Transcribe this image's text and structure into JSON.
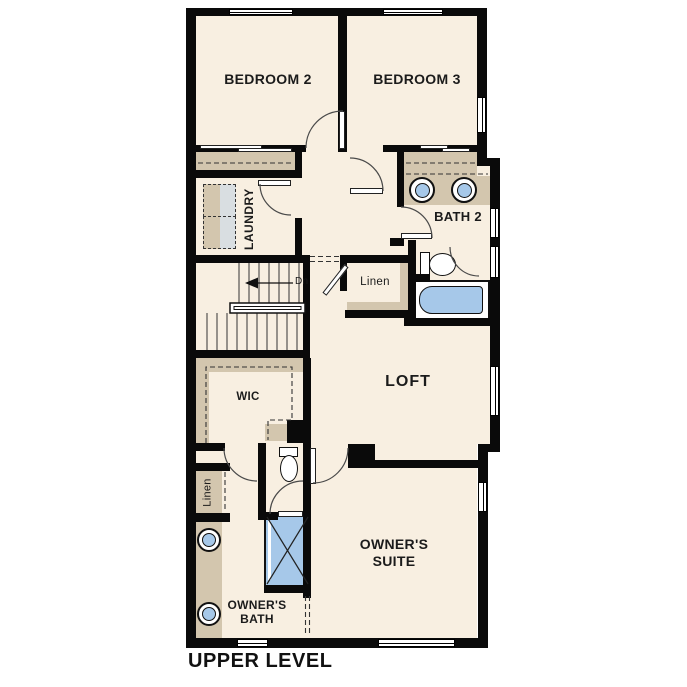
{
  "plan_title": "UPPER LEVEL",
  "labels": {
    "bedroom2": "BEDROOM 2",
    "bedroom3": "BEDROOM 3",
    "laundry": "LAUNDRY",
    "bath2": "BATH 2",
    "linen_hall": "Linen",
    "loft": "LOFT",
    "wic": "WIC",
    "stairs_direction": "Dn",
    "linen_owners": "Linen",
    "owners_suite": "OWNER'S SUITE",
    "owners_bath": "OWNER'S BATH"
  },
  "colors": {
    "floor": "#f8efe1",
    "wall": "#0a0a0a",
    "casework": "#d3c6ae",
    "appliance": "#d9dee1",
    "fixture_blue": "#a6c8e9",
    "background": "#ffffff"
  }
}
